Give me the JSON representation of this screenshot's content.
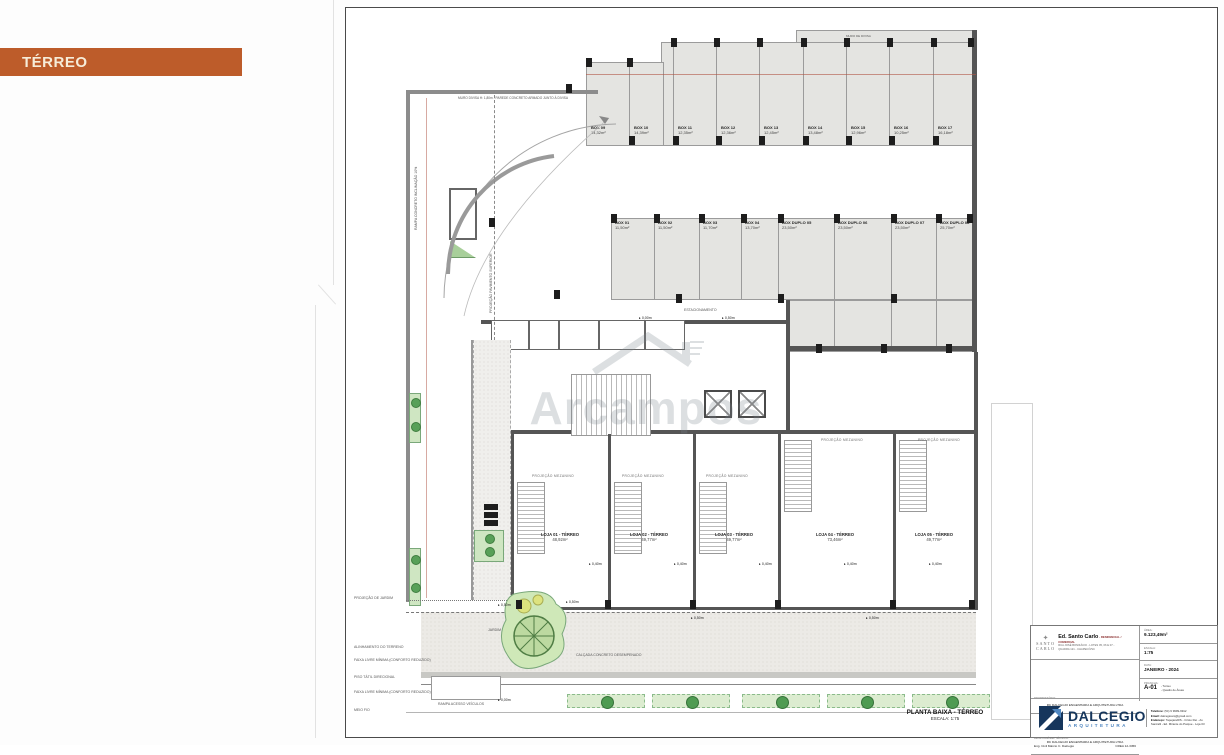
{
  "page": {
    "floor_banner": "TÉRREO"
  },
  "colors": {
    "accent_orange": "#bd5c2a",
    "banner_text": "#f6ecd8",
    "brand_navy": "#16365c",
    "brand_blue": "#4f86c0",
    "plan_green": "#58a058",
    "wall_gray": "#555555",
    "parking_fill": "#e4e4e1"
  },
  "sheet": {
    "plan_title": "PLANTA BAIXA - TÉRREO",
    "plan_scale": "ESCALA: 1:75",
    "watermark": "Arcampos",
    "top_wall_label": "MURO DIVISA H: 1,80m - PAREDE CONCRETO ARMADO JUNTO À DIVISA",
    "boundary_label": "MURO DE DIVISA",
    "ramp_label": "RAMPA CONCRETO INCLINAÇÃO 10%",
    "projection_label": "PROJEÇÃO PAVIMENTO SUPERIOR",
    "parking_label": "ESTACIONAMENTO",
    "mezzanine_label": "PROJEÇÃO MEZANINO",
    "ramp_access_label": "RAMPA ACESSO VEÍCULOS",
    "garden_label": "JARDIM PEDRISCO",
    "sidewalk_label": "CALÇADA CONCRETO DESEMPENADO",
    "box_row1": [
      {
        "label": "BOX 09",
        "area": "14,32m²"
      },
      {
        "label": "BOX 10",
        "area": "14,39m²"
      },
      {
        "label": "BOX 11",
        "area": "12,35m²"
      },
      {
        "label": "BOX 12",
        "area": "12,36m²"
      },
      {
        "label": "BOX 13",
        "area": "12,45m²"
      },
      {
        "label": "BOX 14",
        "area": "13,48m²"
      },
      {
        "label": "BOX 15",
        "area": "12,96m²"
      },
      {
        "label": "BOX 16",
        "area": "10,25m²"
      },
      {
        "label": "BOX 17",
        "area": "16,18m²"
      }
    ],
    "box_row2": [
      {
        "label": "BOX 01",
        "area": "11,50m²"
      },
      {
        "label": "BOX 02",
        "area": "11,50m²"
      },
      {
        "label": "BOX 03",
        "area": "11,70m²"
      },
      {
        "label": "BOX 04",
        "area": "13,70m²"
      },
      {
        "label": "BOX DUPLO 05",
        "area": "23,50m²"
      },
      {
        "label": "BOX DUPLO 06",
        "area": "23,50m²"
      },
      {
        "label": "BOX DUPLO 07",
        "area": "23,50m²"
      },
      {
        "label": "BOX DUPLO 08",
        "area": "25,70m²"
      }
    ],
    "lojas": [
      {
        "label": "LOJA 01 - TÉRREO",
        "area": "48,92m²"
      },
      {
        "label": "LOJA 02 - TÉRREO",
        "area": "49,77m²"
      },
      {
        "label": "LOJA 03 - TÉRREO",
        "area": "49,77m²"
      },
      {
        "label": "LOJA 04 - TÉRREO",
        "area": "73,46m²"
      },
      {
        "label": "LOJA 05 - TÉRREO",
        "area": "49,77m²"
      }
    ],
    "levels": [
      "0,00m",
      "0,50m",
      "0,40m",
      "0,40m",
      "0,40m",
      "0,40m",
      "0,40m",
      "0,50m",
      "0,00m",
      "0,50m",
      "0,50m",
      "0,50m"
    ],
    "margin_notes": [
      "PROJEÇÃO DE JARDIM",
      "ALINHAMENTO DO TERRENO",
      "FAIXA LIVRE MÍNIMA (CONFORTO REDUZIDO)",
      "PISO TÁTIL DIRECIONAL",
      "FAIXA LIVRE MÍNIMA (CONFORTO REDUZIDO)",
      "MEIO FIO"
    ]
  },
  "title_block": {
    "mini_logo_line1": "SANTO",
    "mini_logo_line2": "CARLO",
    "building": "Ed. Santo Carlo",
    "building_suffix": "- RESIDENCIAL / COMERCIAL",
    "address": "RUA JOSÉ BONIFÁCIO - LOTES 05, 06 E 07 - QUADRA 121 - CHAPECÓ/SC",
    "owner_label": "PROPRIETÁRIO:",
    "owner": "RC DALCEGIO ENGENHARIA E ARQUITETURA LTDA",
    "resp_label": "RESPONSÁVEL TÉCNICO:",
    "resp": "RC DALCEGIO ENGENHARIA E ARQUITETURA LTDA",
    "resp2": "Eng. Civil Márcio C. Dalcegio",
    "crea": "CREA 12-3456",
    "area_label": "ÁREA:",
    "area": "9.123,49m²",
    "escala_label": "ESCALA:",
    "escala": "1:75",
    "data_label": "DATA:",
    "data": "JANEIRO - 2024",
    "prancha_label": "PRANCHA:",
    "prancha": "A-01",
    "prancha_item1": "- Térreo",
    "prancha_item2": "- Quadro de Áreas",
    "brand": "DALCEGIO",
    "brand_sub": "ARQUITETURA",
    "phone_label": "Telefone:",
    "phone": "(54) 9 9999-9912",
    "email_label": "Email:",
    "email": "dalcegioarq@gmail.com",
    "address2_label": "Endereço:",
    "address2": "Tapejara/RS - Cristo Rei - Av. Sanzalli - Ed. Mirante do Parque - Loja 03"
  }
}
